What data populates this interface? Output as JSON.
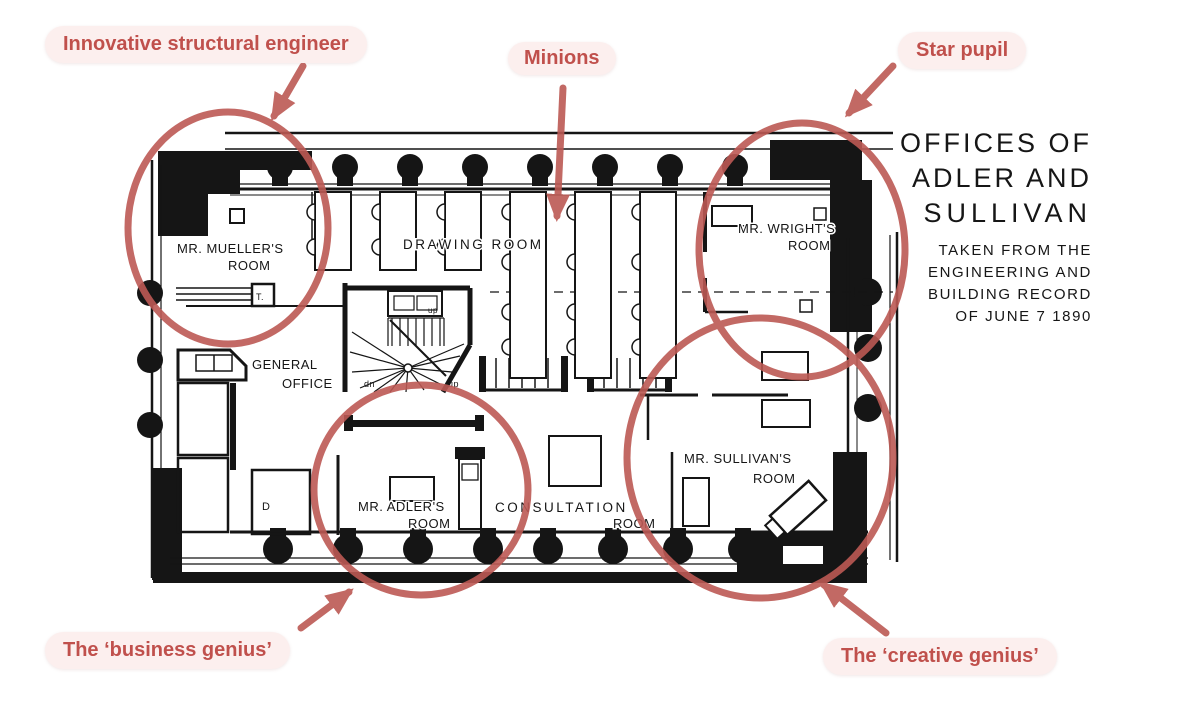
{
  "annotations": {
    "structural_engineer": "Innovative structural engineer",
    "minions": "Minions",
    "star_pupil": "Star pupil",
    "business_genius": "The ‘business genius’",
    "creative_genius": "The ‘creative genius’"
  },
  "title_block": {
    "line1": "OFFICES OF",
    "line2": "ADLER AND",
    "line3": "SULLIVAN",
    "sub_lines": [
      "TAKEN FROM THE",
      "ENGINEERING AND",
      "BUILDING RECORD",
      "OF JUNE 7 1890"
    ]
  },
  "rooms": {
    "mueller": {
      "line1": "MR. MUELLER'S",
      "line2": "ROOM"
    },
    "drawing": {
      "line1": "DRAWING ROOM"
    },
    "wright": {
      "line1": "MR. WRIGHT'S",
      "line2": "ROOM"
    },
    "general": {
      "line1": "GENERAL",
      "line2": "OFFICE"
    },
    "adler": {
      "line1": "MR. ADLER'S",
      "line2": "ROOM"
    },
    "consultation": {
      "line1": "CONSULTATION",
      "line2": "ROOM"
    },
    "sullivan": {
      "line1": "MR. SULLIVAN'S",
      "line2": "ROOM"
    }
  },
  "plan_small_labels": {
    "stair_down": "dn",
    "stair_up": "up",
    "door": "D",
    "t_box": "T."
  },
  "colors": {
    "annotation_red": "#bc5954",
    "badge_bg": "#fcefee",
    "badge_text": "#c0504c",
    "ink": "#151515",
    "background": "#ffffff"
  }
}
